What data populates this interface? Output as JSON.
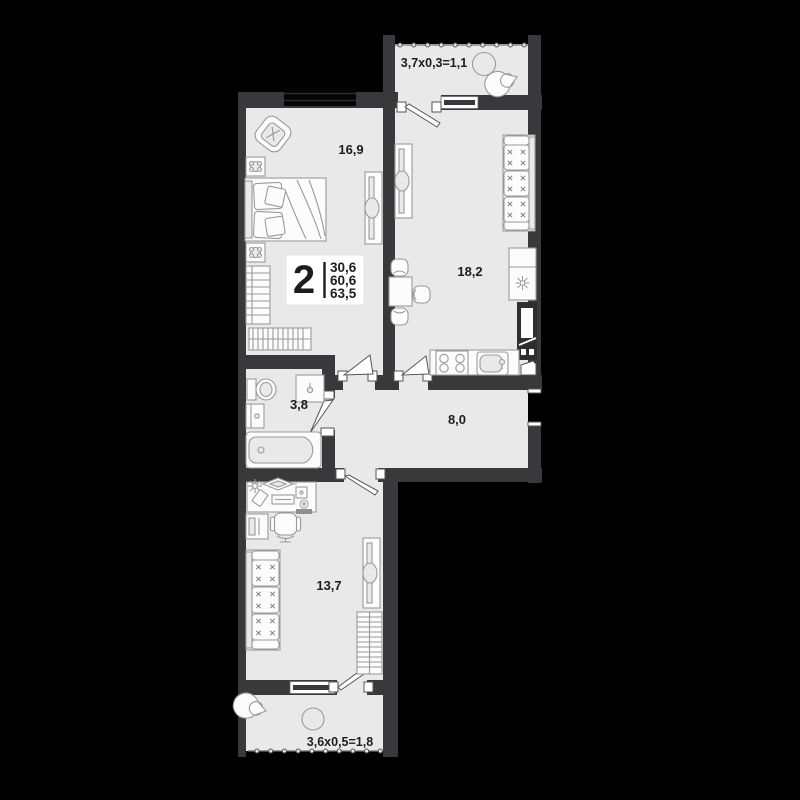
{
  "plan": {
    "type": "apartment-floor-plan",
    "badge": {
      "rooms": "2",
      "living_area": "30,6",
      "area": "60,6",
      "total_area": "63,5"
    },
    "labels": {
      "bedroom": "16,9",
      "kitchen_living": "18,2",
      "bathroom": "3,8",
      "hallway": "8,0",
      "room": "13,7",
      "balcony_top": "3,7х0,3=1,1",
      "balcony_bottom": "3,6х0,5=1,8"
    },
    "colors": {
      "background": "#000000",
      "wall": "#39393b",
      "floor": "#e9e9e9",
      "furniture_line": "#9a9a9a",
      "text": "#1d1d1f",
      "badge_background": "#ffffff"
    }
  }
}
